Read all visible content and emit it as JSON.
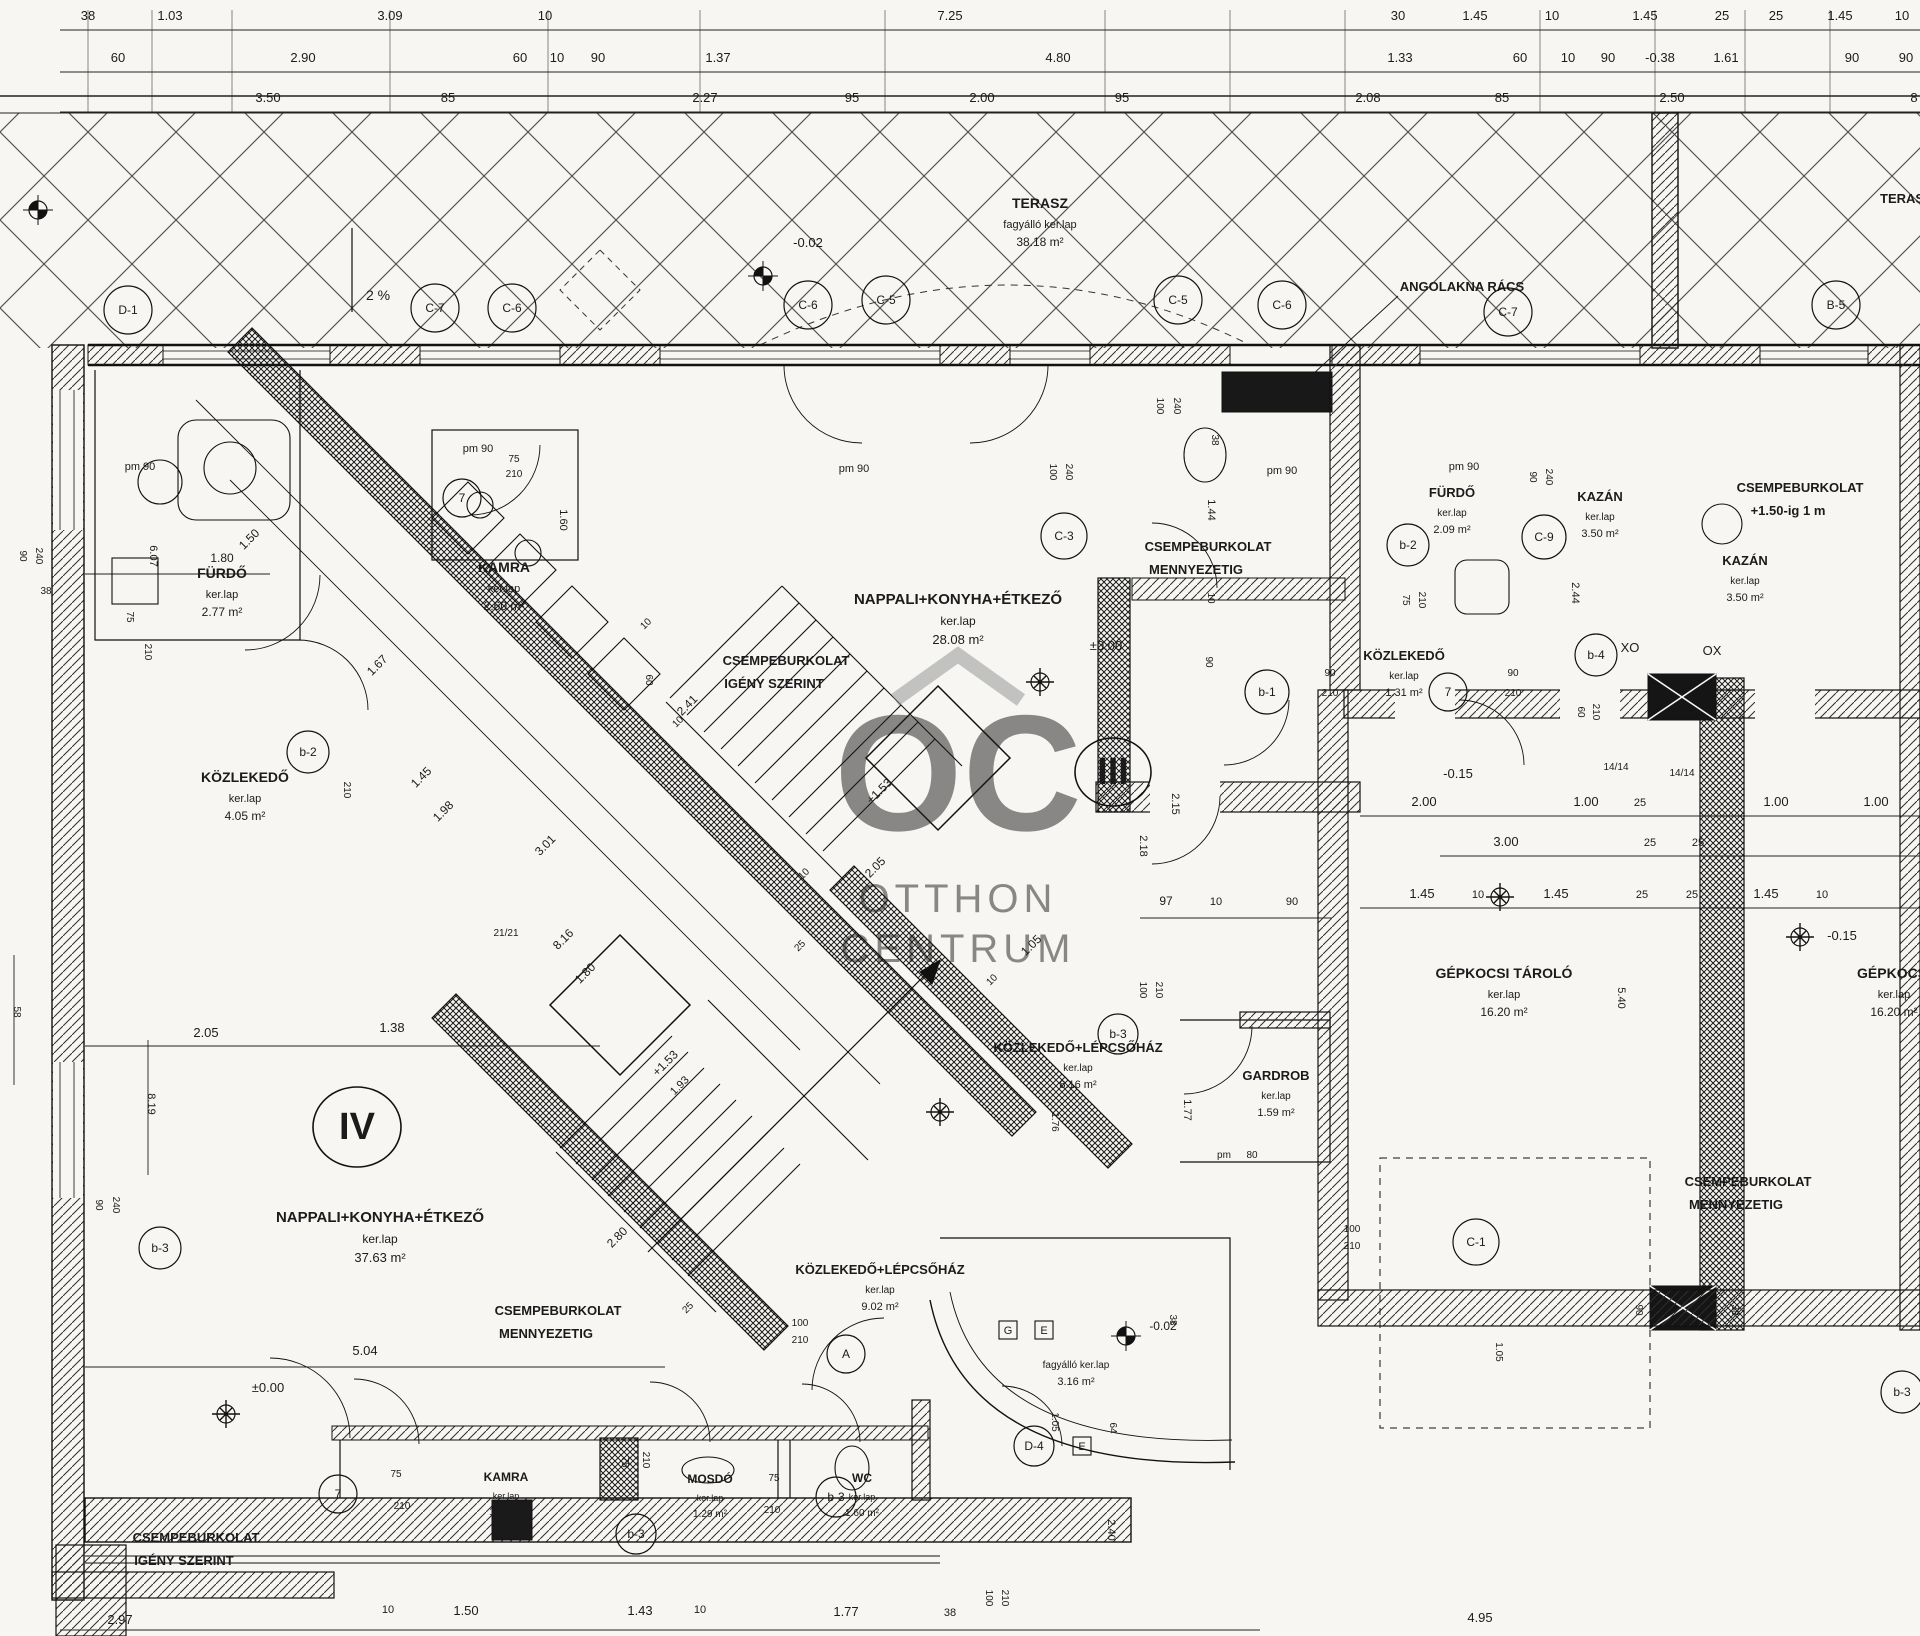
{
  "drawing": {
    "type": "architectural-floor-plan",
    "language": "Hungarian",
    "level_marks": [
      "±0.00",
      "-0.02",
      "-0.15",
      "-0.38",
      "+1.53",
      "+1.50-ig 1 m",
      "2 %"
    ],
    "ink": "#1b1b1b",
    "paper": "#f7f6f3"
  },
  "watermark": {
    "logo": "OC",
    "line1": "OTTHON",
    "line2": "CENTRUM",
    "color": "#8f8f8f"
  },
  "rooms": [
    {
      "name": "TERASZ",
      "ker": "fagyálló ker.lap",
      "area": "38.18 m²",
      "x": 1040,
      "y": 208,
      "s": 14
    },
    {
      "name": "FÜRDŐ",
      "ker": "ker.lap",
      "area": "2.77 m²",
      "x": 222,
      "y": 578,
      "s": 14
    },
    {
      "name": "KAMRA",
      "ker": "ker.lap",
      "area": "2.60 m²",
      "x": 504,
      "y": 572,
      "s": 14
    },
    {
      "name": "KÖZLEKEDŐ",
      "ker": "ker.lap",
      "area": "4.05 m²",
      "x": 245,
      "y": 782,
      "s": 14
    },
    {
      "name": "NAPPALI+KONYHA+ÉTKEZŐ",
      "ker": "ker.lap",
      "area": "28.08 m²",
      "x": 958,
      "y": 604,
      "s": 15
    },
    {
      "name": "FÜRDŐ",
      "ker": "ker.lap",
      "area": "2.09 m²",
      "x": 1452,
      "y": 497,
      "s": 13
    },
    {
      "name": "KAZÁN",
      "ker": "ker.lap",
      "area": "3.50 m²",
      "x": 1600,
      "y": 501,
      "s": 13
    },
    {
      "name": "KAZÁN",
      "ker": "ker.lap",
      "area": "3.50 m²",
      "x": 1745,
      "y": 565,
      "s": 13
    },
    {
      "name": "KÖZLEKEDŐ",
      "ker": "ker.lap",
      "area": "1.31 m²",
      "x": 1404,
      "y": 660,
      "s": 13
    },
    {
      "name": "GÉPKOCSI TÁROLÓ",
      "ker": "ker.lap",
      "area": "16.20 m²",
      "x": 1504,
      "y": 978,
      "s": 14
    },
    {
      "name": "GÉPKOCSI",
      "ker": "ker.lap",
      "area": "16.20 m²",
      "x": 1894,
      "y": 978,
      "s": 14
    },
    {
      "name": "KÖZLEKEDŐ+LÉPCSŐHÁZ",
      "ker": "ker.lap",
      "area": "8.16 m²",
      "x": 1078,
      "y": 1052,
      "s": 13
    },
    {
      "name": "GARDROB",
      "ker": "ker.lap",
      "area": "1.59 m²",
      "x": 1276,
      "y": 1080,
      "s": 13
    },
    {
      "name": "NAPPALI+KONYHA+ÉTKEZŐ",
      "ker": "ker.lap",
      "area": "37.63 m²",
      "x": 380,
      "y": 1222,
      "s": 15
    },
    {
      "name": "KÖZLEKEDŐ+LÉPCSŐHÁZ",
      "ker": "ker.lap",
      "area": "9.02 m²",
      "x": 880,
      "y": 1274,
      "s": 13
    },
    {
      "name": "",
      "ker": "fagyálló ker.lap",
      "area": "3.16 m²",
      "x": 1076,
      "y": 1368,
      "s": 13
    },
    {
      "name": "KAMRA",
      "ker": "ker.lap",
      "area": "1.36 m²",
      "x": 506,
      "y": 1481,
      "s": 12
    },
    {
      "name": "MOSDÓ",
      "ker": "ker.lap",
      "area": "1.29 m²",
      "x": 710,
      "y": 1483,
      "s": 12
    },
    {
      "name": "WC",
      "ker": "ker.lap",
      "area": "1.60 m²",
      "x": 862,
      "y": 1482,
      "s": 12
    }
  ],
  "notes": [
    {
      "l1": "CSEMPEBURKOLAT",
      "l2": "IGÉNY SZERINT",
      "x": 786,
      "y": 665
    },
    {
      "l1": "CSEMPEBURKOLAT",
      "l2": "MENNYEZETIG",
      "x": 1208,
      "y": 551
    },
    {
      "l1": "CSEMPEBURKOLAT",
      "l2": "MENNYEZETIG",
      "x": 558,
      "y": 1315
    },
    {
      "l1": "CSEMPEBURKOLAT",
      "l2": "MENNYEZETIG",
      "x": 1748,
      "y": 1186
    },
    {
      "l1": "CSEMPEBURKOLAT",
      "l2": "IGÉNY SZERINT",
      "x": 196,
      "y": 1542
    },
    {
      "l1": "CSEMPEBURKOLAT",
      "l2": "+1.50-ig 1 m",
      "x": 1800,
      "y": 492
    },
    {
      "l1": "ANGOLAKNA RÁCS",
      "l2": "",
      "x": 1462,
      "y": 291
    },
    {
      "l1": "TERASZ",
      "l2": "",
      "x": 1906,
      "y": 203
    }
  ],
  "labels": [
    {
      "t": "38",
      "x": 88,
      "y": 20
    },
    {
      "t": "1.03",
      "x": 170,
      "y": 20
    },
    {
      "t": "3.09",
      "x": 390,
      "y": 20
    },
    {
      "t": "10",
      "x": 545,
      "y": 20
    },
    {
      "t": "7.25",
      "x": 950,
      "y": 20
    },
    {
      "t": "30",
      "x": 1398,
      "y": 20
    },
    {
      "t": "1.45",
      "x": 1475,
      "y": 20
    },
    {
      "t": "10",
      "x": 1552,
      "y": 20
    },
    {
      "t": "1.45",
      "x": 1645,
      "y": 20
    },
    {
      "t": "25",
      "x": 1722,
      "y": 20
    },
    {
      "t": "25",
      "x": 1776,
      "y": 20
    },
    {
      "t": "1.45",
      "x": 1840,
      "y": 20
    },
    {
      "t": "10",
      "x": 1902,
      "y": 20
    },
    {
      "t": "60",
      "x": 118,
      "y": 62
    },
    {
      "t": "2.90",
      "x": 303,
      "y": 62
    },
    {
      "t": "60",
      "x": 520,
      "y": 62
    },
    {
      "t": "10",
      "x": 557,
      "y": 62
    },
    {
      "t": "90",
      "x": 598,
      "y": 62
    },
    {
      "t": "1.37",
      "x": 718,
      "y": 62
    },
    {
      "t": "4.80",
      "x": 1058,
      "y": 62
    },
    {
      "t": "1.33",
      "x": 1400,
      "y": 62
    },
    {
      "t": "60",
      "x": 1520,
      "y": 62
    },
    {
      "t": "10",
      "x": 1568,
      "y": 62
    },
    {
      "t": "90",
      "x": 1608,
      "y": 62
    },
    {
      "t": "-0.38",
      "x": 1660,
      "y": 62
    },
    {
      "t": "1.61",
      "x": 1726,
      "y": 62
    },
    {
      "t": "90",
      "x": 1852,
      "y": 62
    },
    {
      "t": "90",
      "x": 1906,
      "y": 62
    },
    {
      "t": "3.50",
      "x": 268,
      "y": 102
    },
    {
      "t": "85",
      "x": 448,
      "y": 102
    },
    {
      "t": "2.27",
      "x": 705,
      "y": 102
    },
    {
      "t": "95",
      "x": 852,
      "y": 102
    },
    {
      "t": "2.00",
      "x": 982,
      "y": 102
    },
    {
      "t": "95",
      "x": 1122,
      "y": 102
    },
    {
      "t": "2.08",
      "x": 1368,
      "y": 102
    },
    {
      "t": "85",
      "x": 1502,
      "y": 102
    },
    {
      "t": "2.50",
      "x": 1672,
      "y": 102
    },
    {
      "t": "8",
      "x": 1914,
      "y": 102
    },
    {
      "t": "2 %",
      "x": 378,
      "y": 300,
      "s": 14
    },
    {
      "t": "-0.02",
      "x": 808,
      "y": 247
    },
    {
      "t": "pm 90",
      "x": 140,
      "y": 470,
      "s": 11
    },
    {
      "t": "1.50",
      "x": 252,
      "y": 542,
      "r": -45,
      "s": 12
    },
    {
      "t": "6.07",
      "x": 150,
      "y": 556,
      "r": 90,
      "s": 11
    },
    {
      "t": "75",
      "x": 127,
      "y": 617,
      "r": 90,
      "s": 10
    },
    {
      "t": "210",
      "x": 145,
      "y": 652,
      "r": 90,
      "s": 10
    },
    {
      "t": "90",
      "x": 20,
      "y": 556,
      "r": 90,
      "s": 10
    },
    {
      "t": "240",
      "x": 36,
      "y": 556,
      "r": 90,
      "s": 10
    },
    {
      "t": "38",
      "x": 46,
      "y": 594,
      "s": 10
    },
    {
      "t": "1.80",
      "x": 222,
      "y": 562,
      "s": 12
    },
    {
      "t": "pm 90",
      "x": 478,
      "y": 452,
      "s": 11
    },
    {
      "t": "75",
      "x": 514,
      "y": 462,
      "s": 10
    },
    {
      "t": "210",
      "x": 514,
      "y": 477,
      "s": 10
    },
    {
      "t": "1.60",
      "x": 560,
      "y": 520,
      "r": 90,
      "s": 11
    },
    {
      "t": "pm 90",
      "x": 854,
      "y": 472,
      "s": 11
    },
    {
      "t": "100",
      "x": 1050,
      "y": 472,
      "r": 90,
      "s": 10
    },
    {
      "t": "240",
      "x": 1066,
      "y": 472,
      "r": 90,
      "s": 10
    },
    {
      "t": "pm 90",
      "x": 1282,
      "y": 474,
      "s": 11
    },
    {
      "t": "100",
      "x": 1157,
      "y": 406,
      "r": 90,
      "s": 10
    },
    {
      "t": "240",
      "x": 1174,
      "y": 406,
      "r": 90,
      "s": 10
    },
    {
      "t": "38",
      "x": 1212,
      "y": 440,
      "r": 90,
      "s": 10
    },
    {
      "t": "1.44",
      "x": 1208,
      "y": 510,
      "r": 90,
      "s": 11
    },
    {
      "t": "10",
      "x": 1208,
      "y": 598,
      "r": 90,
      "s": 10
    },
    {
      "t": "90",
      "x": 1206,
      "y": 662,
      "r": 90,
      "s": 10
    },
    {
      "t": "pm 90",
      "x": 1464,
      "y": 470,
      "s": 11
    },
    {
      "t": "90",
      "x": 1530,
      "y": 477,
      "r": 90,
      "s": 10
    },
    {
      "t": "240",
      "x": 1546,
      "y": 477,
      "r": 90,
      "s": 10
    },
    {
      "t": "75",
      "x": 1403,
      "y": 600,
      "r": 90,
      "s": 10
    },
    {
      "t": "210",
      "x": 1419,
      "y": 600,
      "r": 90,
      "s": 10
    },
    {
      "t": "2.44",
      "x": 1572,
      "y": 593,
      "r": 90,
      "s": 11
    },
    {
      "t": "90",
      "x": 1330,
      "y": 676,
      "s": 10
    },
    {
      "t": "210",
      "x": 1330,
      "y": 696,
      "s": 10
    },
    {
      "t": "90",
      "x": 1513,
      "y": 676,
      "s": 10
    },
    {
      "t": "210",
      "x": 1513,
      "y": 696,
      "s": 10
    },
    {
      "t": "60",
      "x": 1578,
      "y": 712,
      "r": 90,
      "s": 10
    },
    {
      "t": "210",
      "x": 1593,
      "y": 712,
      "r": 90,
      "s": 10
    },
    {
      "t": "XO",
      "x": 1630,
      "y": 652,
      "s": 13
    },
    {
      "t": "OX",
      "x": 1712,
      "y": 655,
      "s": 13
    },
    {
      "t": "-0.15",
      "x": 1458,
      "y": 778
    },
    {
      "t": "14/14",
      "x": 1616,
      "y": 770,
      "s": 10
    },
    {
      "t": "14/14",
      "x": 1682,
      "y": 776,
      "s": 10
    },
    {
      "t": "2.00",
      "x": 1424,
      "y": 806
    },
    {
      "t": "1.00",
      "x": 1586,
      "y": 806
    },
    {
      "t": "25",
      "x": 1640,
      "y": 806,
      "s": 11
    },
    {
      "t": "1.00",
      "x": 1776,
      "y": 806
    },
    {
      "t": "1.00",
      "x": 1876,
      "y": 806
    },
    {
      "t": "3.00",
      "x": 1506,
      "y": 846
    },
    {
      "t": "25",
      "x": 1650,
      "y": 846,
      "s": 11
    },
    {
      "t": "25",
      "x": 1698,
      "y": 846,
      "s": 11
    },
    {
      "t": "1.45",
      "x": 1422,
      "y": 898
    },
    {
      "t": "10",
      "x": 1478,
      "y": 898,
      "s": 11
    },
    {
      "t": "1.45",
      "x": 1556,
      "y": 898
    },
    {
      "t": "25",
      "x": 1642,
      "y": 898,
      "s": 11
    },
    {
      "t": "25",
      "x": 1692,
      "y": 898,
      "s": 11
    },
    {
      "t": "1.45",
      "x": 1766,
      "y": 898
    },
    {
      "t": "10",
      "x": 1822,
      "y": 898,
      "s": 11
    },
    {
      "t": "5.40",
      "x": 1618,
      "y": 998,
      "r": 90,
      "s": 11
    },
    {
      "t": "-0.15",
      "x": 1842,
      "y": 940
    },
    {
      "t": "90",
      "x": 1636,
      "y": 1310,
      "r": 90,
      "s": 10
    },
    {
      "t": "38",
      "x": 1732,
      "y": 1310,
      "r": 90,
      "s": 10
    },
    {
      "t": "2.18",
      "x": 1140,
      "y": 846,
      "r": 90,
      "s": 11
    },
    {
      "t": "2.15",
      "x": 1172,
      "y": 804,
      "r": 90,
      "s": 11
    },
    {
      "t": "97",
      "x": 1166,
      "y": 905,
      "s": 12
    },
    {
      "t": "10",
      "x": 1216,
      "y": 905,
      "s": 11
    },
    {
      "t": "90",
      "x": 1292,
      "y": 905,
      "s": 11
    },
    {
      "t": "2.05",
      "x": 878,
      "y": 870,
      "r": -45,
      "s": 12
    },
    {
      "t": "10",
      "x": 806,
      "y": 876,
      "r": -45,
      "s": 10
    },
    {
      "t": "25",
      "x": 802,
      "y": 948,
      "r": -45,
      "s": 10
    },
    {
      "t": "1.05",
      "x": 1034,
      "y": 948,
      "r": -45,
      "s": 12
    },
    {
      "t": "10",
      "x": 994,
      "y": 982,
      "r": -45,
      "s": 10
    },
    {
      "t": "100",
      "x": 1140,
      "y": 990,
      "r": 90,
      "s": 10
    },
    {
      "t": "210",
      "x": 1156,
      "y": 990,
      "r": 90,
      "s": 10
    },
    {
      "t": "+1.53",
      "x": 882,
      "y": 794,
      "r": -45,
      "s": 12
    },
    {
      "t": "+1.53",
      "x": 668,
      "y": 1066,
      "r": -45,
      "s": 12
    },
    {
      "t": "1.93",
      "x": 682,
      "y": 1088,
      "r": -45,
      "s": 11
    },
    {
      "t": "21/21",
      "x": 506,
      "y": 936,
      "s": 10
    },
    {
      "t": "60",
      "x": 646,
      "y": 680,
      "r": 90,
      "s": 10
    },
    {
      "t": "10",
      "x": 680,
      "y": 724,
      "r": -45,
      "s": 10
    },
    {
      "t": "1.67",
      "x": 380,
      "y": 668,
      "r": -45,
      "s": 12
    },
    {
      "t": "1.45",
      "x": 424,
      "y": 780,
      "r": -45,
      "s": 12
    },
    {
      "t": "1.98",
      "x": 446,
      "y": 814,
      "r": -45,
      "s": 12
    },
    {
      "t": "3.01",
      "x": 548,
      "y": 848,
      "r": -45,
      "s": 12
    },
    {
      "t": "2.41",
      "x": 690,
      "y": 708,
      "r": -45,
      "s": 12
    },
    {
      "t": "10",
      "x": 648,
      "y": 626,
      "r": -45,
      "s": 10
    },
    {
      "t": "8.16",
      "x": 566,
      "y": 942,
      "r": -45,
      "s": 12
    },
    {
      "t": "1.80",
      "x": 588,
      "y": 976,
      "r": -45,
      "s": 12
    },
    {
      "t": "210",
      "x": 344,
      "y": 790,
      "r": 90,
      "s": 10
    },
    {
      "t": "58",
      "x": 14,
      "y": 1012,
      "r": 90,
      "s": 10
    },
    {
      "t": "2.05",
      "x": 206,
      "y": 1037
    },
    {
      "t": "1.38",
      "x": 392,
      "y": 1032
    },
    {
      "t": "8.19",
      "x": 148,
      "y": 1104,
      "r": 90,
      "s": 11
    },
    {
      "t": "90",
      "x": 96,
      "y": 1205,
      "r": 90,
      "s": 10
    },
    {
      "t": "240",
      "x": 113,
      "y": 1205,
      "r": 90,
      "s": 10
    },
    {
      "t": "±0.00",
      "x": 268,
      "y": 1392
    },
    {
      "t": "5.04",
      "x": 365,
      "y": 1355
    },
    {
      "t": "2.80",
      "x": 620,
      "y": 1240,
      "r": -45,
      "s": 12
    },
    {
      "t": "25",
      "x": 690,
      "y": 1310,
      "r": -45,
      "s": 10
    },
    {
      "t": "±0.00",
      "x": 1106,
      "y": 650
    },
    {
      "t": "1.77",
      "x": 1184,
      "y": 1110,
      "r": 90,
      "s": 11
    },
    {
      "t": "pm",
      "x": 1224,
      "y": 1158,
      "s": 10
    },
    {
      "t": "80",
      "x": 1252,
      "y": 1158,
      "s": 10
    },
    {
      "t": "1.76",
      "x": 1052,
      "y": 1122,
      "r": 90,
      "s": 10
    },
    {
      "t": "-0.02",
      "x": 1163,
      "y": 1330,
      "s": 12
    },
    {
      "t": "100",
      "x": 800,
      "y": 1326,
      "s": 10
    },
    {
      "t": "210",
      "x": 800,
      "y": 1343,
      "s": 10
    },
    {
      "t": "1.05",
      "x": 1052,
      "y": 1422,
      "r": 90,
      "s": 10
    },
    {
      "t": "64",
      "x": 1110,
      "y": 1428,
      "r": 90,
      "s": 10
    },
    {
      "t": "2.40",
      "x": 1108,
      "y": 1530,
      "r": 90,
      "s": 11
    },
    {
      "t": "38",
      "x": 1170,
      "y": 1320,
      "r": 90,
      "s": 10
    },
    {
      "t": "100",
      "x": 1352,
      "y": 1232,
      "s": 10
    },
    {
      "t": "210",
      "x": 1352,
      "y": 1249,
      "s": 10
    },
    {
      "t": "1.05",
      "x": 1496,
      "y": 1352,
      "r": 90,
      "s": 10
    },
    {
      "t": "4.95",
      "x": 1480,
      "y": 1622
    },
    {
      "t": "75",
      "x": 396,
      "y": 1477,
      "s": 10
    },
    {
      "t": "210",
      "x": 402,
      "y": 1509,
      "s": 10
    },
    {
      "t": "75",
      "x": 622,
      "y": 1462,
      "r": 90,
      "s": 10
    },
    {
      "t": "210",
      "x": 643,
      "y": 1460,
      "r": 90,
      "s": 10
    },
    {
      "t": "75",
      "x": 774,
      "y": 1481,
      "s": 10
    },
    {
      "t": "210",
      "x": 772,
      "y": 1513,
      "s": 10
    },
    {
      "t": "2.97",
      "x": 120,
      "y": 1624
    },
    {
      "t": "10",
      "x": 388,
      "y": 1613,
      "s": 11
    },
    {
      "t": "1.50",
      "x": 466,
      "y": 1615
    },
    {
      "t": "1.43",
      "x": 640,
      "y": 1615
    },
    {
      "t": "10",
      "x": 700,
      "y": 1613,
      "s": 11
    },
    {
      "t": "1.77",
      "x": 846,
      "y": 1616
    },
    {
      "t": "38",
      "x": 950,
      "y": 1616,
      "s": 11
    },
    {
      "t": "100",
      "x": 986,
      "y": 1598,
      "r": 90,
      "s": 10
    },
    {
      "t": "210",
      "x": 1002,
      "y": 1598,
      "r": 90,
      "s": 10
    }
  ],
  "bubbles": [
    {
      "t": "D-1",
      "x": 128,
      "y": 310,
      "rad": 24
    },
    {
      "t": "C-7",
      "x": 435,
      "y": 308,
      "rad": 24
    },
    {
      "t": "C-6",
      "x": 512,
      "y": 308,
      "rad": 24
    },
    {
      "t": "C-6",
      "x": 808,
      "y": 305,
      "rad": 24
    },
    {
      "t": "C-5",
      "x": 886,
      "y": 300,
      "rad": 24
    },
    {
      "t": "C-5",
      "x": 1178,
      "y": 300,
      "rad": 24
    },
    {
      "t": "C-6",
      "x": 1282,
      "y": 305,
      "rad": 24
    },
    {
      "t": "C-7",
      "x": 1508,
      "y": 312,
      "rad": 24
    },
    {
      "t": "B-5",
      "x": 1836,
      "y": 305,
      "rad": 24
    },
    {
      "t": "7",
      "x": 462,
      "y": 498,
      "rad": 19
    },
    {
      "t": "b-2",
      "x": 308,
      "y": 752,
      "rad": 21
    },
    {
      "t": "C-3",
      "x": 1064,
      "y": 536,
      "rad": 23
    },
    {
      "t": "b-2",
      "x": 1408,
      "y": 545,
      "rad": 21
    },
    {
      "t": "C-9",
      "x": 1544,
      "y": 537,
      "rad": 22
    },
    {
      "t": "b-1",
      "x": 1267,
      "y": 692,
      "rad": 22
    },
    {
      "t": "7",
      "x": 1448,
      "y": 692,
      "rad": 19
    },
    {
      "t": "b-4",
      "x": 1596,
      "y": 655,
      "rad": 21
    },
    {
      "t": "b-3",
      "x": 1118,
      "y": 1034,
      "rad": 20
    },
    {
      "t": "A",
      "x": 846,
      "y": 1354,
      "rad": 19
    },
    {
      "t": "D-4",
      "x": 1034,
      "y": 1446,
      "rad": 20
    },
    {
      "t": "7",
      "x": 338,
      "y": 1494,
      "rad": 19
    },
    {
      "t": "b-3",
      "x": 636,
      "y": 1534,
      "rad": 20
    },
    {
      "t": "b-3",
      "x": 836,
      "y": 1497,
      "rad": 20
    },
    {
      "t": "C-1",
      "x": 1476,
      "y": 1242,
      "rad": 23
    },
    {
      "t": "b-3",
      "x": 1902,
      "y": 1392,
      "rad": 21
    },
    {
      "t": "b-3",
      "x": 160,
      "y": 1248,
      "rad": 21
    }
  ],
  "units": [
    {
      "t": "III",
      "x": 1113,
      "y": 772,
      "rad": 38
    },
    {
      "t": "IV",
      "x": 357,
      "y": 1127,
      "rad": 44
    }
  ],
  "squares": [
    {
      "t": "G",
      "x": 1008,
      "y": 1330
    },
    {
      "t": "E",
      "x": 1044,
      "y": 1330
    },
    {
      "t": "E",
      "x": 1082,
      "y": 1446
    }
  ],
  "benchmarks": [
    {
      "x": 763,
      "y": 276
    },
    {
      "x": 1126,
      "y": 1336
    },
    {
      "x": 38,
      "y": 210
    }
  ],
  "lights": [
    {
      "x": 1040,
      "y": 682
    },
    {
      "x": 226,
      "y": 1414
    },
    {
      "x": 940,
      "y": 1112
    },
    {
      "x": 1500,
      "y": 897
    },
    {
      "x": 1800,
      "y": 937
    }
  ]
}
